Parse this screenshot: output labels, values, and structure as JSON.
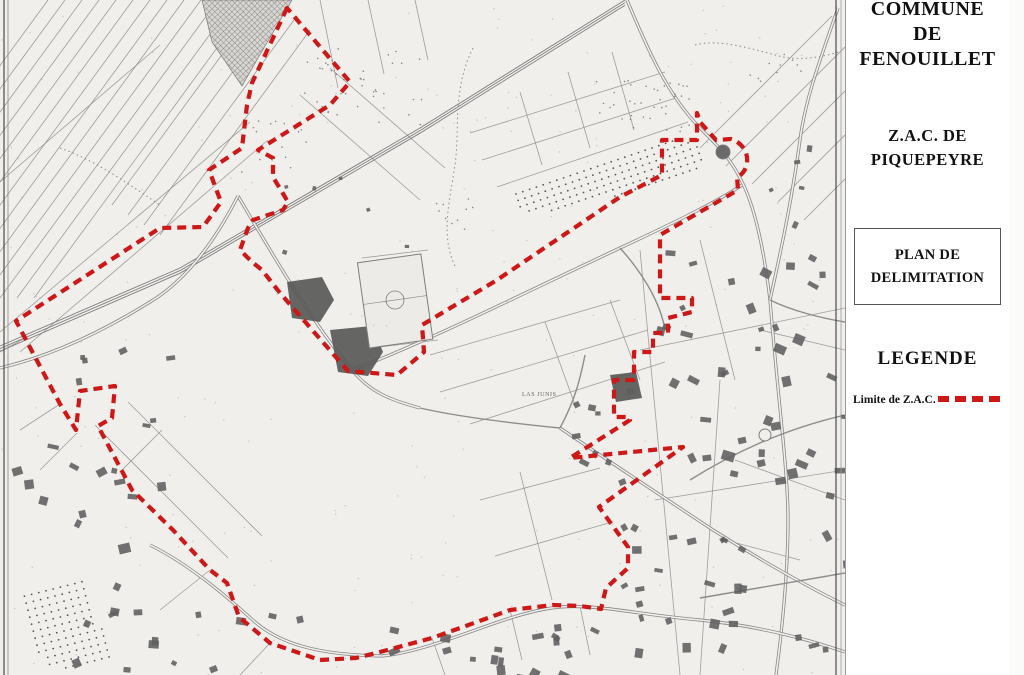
{
  "sidebar": {
    "commune_lines": [
      "COMMUNE",
      "DE",
      "FENOUILLET"
    ],
    "zac_lines": [
      "Z.A.C. DE",
      "PIQUEPEYRE"
    ],
    "plan_lines": [
      "PLAN DE",
      "DELIMITATION"
    ],
    "legend_title": "LEGENDE",
    "legend_item_label": "Limite de Z.A.C."
  },
  "map": {
    "place_label": {
      "text": "LAS JUNIS",
      "x": 522,
      "y": 396
    },
    "colors": {
      "red": "#ce1717",
      "paper": "#f1efec",
      "ink": "#8e8e8e",
      "building": "#5f5f5f",
      "dark": "#555555",
      "frame": "#4a4a4a"
    },
    "boundary": "M287,8 L252,83 L247,105 L242,148 L209,170 L221,202 L203,227 L160,228 L16,321 L25,338 L60,404 L76,430 L80,391 L115,386 L112,418 L98,426 L132,490 L173,530 L210,570 L227,583 L239,617 L270,643 L320,660 L356,658 L380,652 L432,638 L474,623 L510,610 L553,605 L580,606 L601,609 L606,588 L628,568 L628,547 L599,507 L683,447 L570,458 L630,420 L629,417 L614,417 L614,380 L634,380 L634,352 L653,352 L653,333 L668,333 L668,318 L692,312 L692,298 L660,298 L660,235 L738,190 L737,177 C751,171 752,146 731,139 L716,140 L700,122 L697,113 L697,140 L662,140 L662,175 L620,197 L497,280 L422,325 L424,352 L397,375 L348,371 L280,293 L262,270 L252,262 L240,250 L248,228 L253,220 L283,210 L288,202 L273,177 L273,158 L258,150 L330,105 L350,82 Z",
    "boundary_width": 4.2,
    "boundary_dash": "9 6",
    "railway": {
      "d": "M625,0 L420,128 L180,268 L0,346",
      "offsets": [
        0,
        2.6,
        5.2
      ]
    },
    "roads_double": [
      "M627,0 C650,55 668,95 700,128 C718,146 730,158 740,178 C755,205 764,250 770,300 C778,400 788,470 788,520 C788,575 782,630 776,675",
      "M150,545 C190,565 225,595 255,622 C285,648 330,655 382,656 C440,650 505,612 560,607 C600,604 640,615 700,620 C760,626 810,640 845,652",
      "M560,428 C610,462 660,495 710,528 C760,560 810,588 845,605",
      "M238,196 C270,250 310,320 352,370 C370,392 390,400 420,408",
      "M0,368 C55,355 105,330 150,302 C190,278 218,235 238,196",
      "M838,8 C820,60 805,100 800,140 C792,200 780,255 770,300",
      "M352,370 C420,345 520,295 620,248 C680,220 720,200 742,185"
    ],
    "roads_single": [
      "M420,408 C450,415 500,422 560,428",
      "M560,428 C575,400 580,380 585,355",
      "M690,480 C730,455 780,430 845,415",
      "M700,598 L845,573",
      "M770,300 C790,310 820,318 845,322",
      "M620,248 C640,270 660,300 665,330"
    ],
    "parcel_fans": [
      {
        "x0": 48,
        "y0": 0,
        "sx": 17,
        "sy": 0,
        "dx": -218,
        "dy": 298,
        "n": 13
      },
      {
        "x0": 262,
        "y0": 0,
        "sx": 16,
        "sy": 10,
        "dx": -150,
        "dy": 205,
        "n": 4
      },
      {
        "x0": 700,
        "y0": 148,
        "sx": 26,
        "sy": 18,
        "dx": 132,
        "dy": -132,
        "n": 5
      }
    ],
    "parcel_lines": [
      "M0,182 L160,45",
      "M0,332 L250,122",
      "M20,352 L268,140",
      "M470,133 L665,72",
      "M482,160 L676,98",
      "M497,187 L688,122",
      "M520,92 L542,165",
      "M568,72 L590,148",
      "M612,52 L634,130",
      "M320,0 L338,88",
      "M368,0 L384,74",
      "M415,0 L428,60",
      "M430,355 L620,300",
      "M440,392 L648,330",
      "M470,424 L665,362",
      "M545,322 L575,405",
      "M610,300 L640,380",
      "M480,500 L600,468",
      "M495,556 L612,522",
      "M520,472 L552,600",
      "M95,425 L228,558",
      "M128,402 L262,536",
      "M162,430 L120,472",
      "M640,250 L680,675",
      "M700,240 L735,380",
      "M720,380 L700,675",
      "M760,330 L845,350",
      "M735,460 L845,500",
      "M725,540 L800,560",
      "M300,95 L420,200",
      "M330,68 L445,168",
      "M25,338 L0,352",
      "M60,404 L20,430",
      "M77,433 L40,470",
      "M210,570 L160,610",
      "M270,643 L240,675",
      "M432,638 L445,675",
      "M510,610 L522,660",
      "M580,606 L590,655",
      "M362,258 L428,250",
      "M372,348 L438,340",
      "M640,350 L845,308",
      "M655,500 L845,470"
    ],
    "streams": [
      "M695,45 C720,38 755,50 783,57 C800,60 820,58 838,52",
      "M473,48 C452,90 460,130 455,165 C450,200 440,235 455,266",
      "M60,148 C95,160 130,185 160,205"
    ],
    "hatch_polys": [
      "202,0 292,0 258,58 242,86 212,42"
    ],
    "dark_polys": [
      "287,282 322,277 334,300 320,322 292,318",
      "330,330 372,326 383,352 368,376 338,372",
      "610,375 636,372 642,398 616,402"
    ],
    "orchards": [
      {
        "poly": "495,196 652,141 703,141 703,171 560,212 500,212",
        "u": [
          6.8,
          -2.3
        ],
        "v": [
          2.1,
          6.4
        ],
        "origin": [
          495,
          130
        ]
      },
      {
        "poly": "20,593 85,577 112,660 45,672",
        "u": [
          7.2,
          -1.8
        ],
        "v": [
          1.8,
          7.0
        ],
        "origin": [
          10,
          570
        ]
      }
    ],
    "speckles": [
      {
        "cx": 370,
        "cy": 88,
        "rx": 70,
        "ry": 40,
        "n": 42
      },
      {
        "cx": 645,
        "cy": 108,
        "rx": 55,
        "ry": 28,
        "n": 40
      },
      {
        "cx": 272,
        "cy": 150,
        "rx": 35,
        "ry": 30,
        "n": 16
      },
      {
        "cx": 450,
        "cy": 210,
        "rx": 25,
        "ry": 20,
        "n": 10
      },
      {
        "cx": 770,
        "cy": 68,
        "rx": 35,
        "ry": 15,
        "n": 10
      }
    ],
    "building_clusters": [
      {
        "cx": 748,
        "cy": 455,
        "rx": 95,
        "ry": 210,
        "n": 58,
        "smin": 5,
        "smax": 13
      },
      {
        "cx": 520,
        "cy": 648,
        "rx": 135,
        "ry": 26,
        "n": 20,
        "smin": 5,
        "smax": 12
      },
      {
        "cx": 85,
        "cy": 520,
        "rx": 78,
        "ry": 92,
        "n": 16,
        "smin": 5,
        "smax": 12
      },
      {
        "cx": 185,
        "cy": 642,
        "rx": 115,
        "ry": 30,
        "n": 12,
        "smin": 5,
        "smax": 11
      },
      {
        "cx": 592,
        "cy": 420,
        "rx": 42,
        "ry": 65,
        "n": 9,
        "smin": 5,
        "smax": 10
      },
      {
        "cx": 118,
        "cy": 392,
        "rx": 50,
        "ry": 42,
        "n": 7,
        "smin": 4,
        "smax": 9
      },
      {
        "cx": 800,
        "cy": 185,
        "rx": 32,
        "ry": 45,
        "n": 5,
        "smin": 4,
        "smax": 9
      },
      {
        "cx": 348,
        "cy": 212,
        "rx": 75,
        "ry": 45,
        "n": 6,
        "smin": 3,
        "smax": 6
      },
      {
        "cx": 660,
        "cy": 580,
        "rx": 40,
        "ry": 60,
        "n": 10,
        "smin": 4,
        "smax": 10
      }
    ],
    "global_speckle_n": 260,
    "sports_field": {
      "x": 363,
      "y": 258,
      "w": 64,
      "h": 86,
      "rot": -8,
      "cx": 395,
      "cy": 300,
      "r": 9
    },
    "roundabouts": [
      {
        "cx": 723,
        "cy": 152,
        "r": 7,
        "solid": true
      },
      {
        "cx": 765,
        "cy": 435,
        "r": 6,
        "solid": false
      }
    ]
  }
}
